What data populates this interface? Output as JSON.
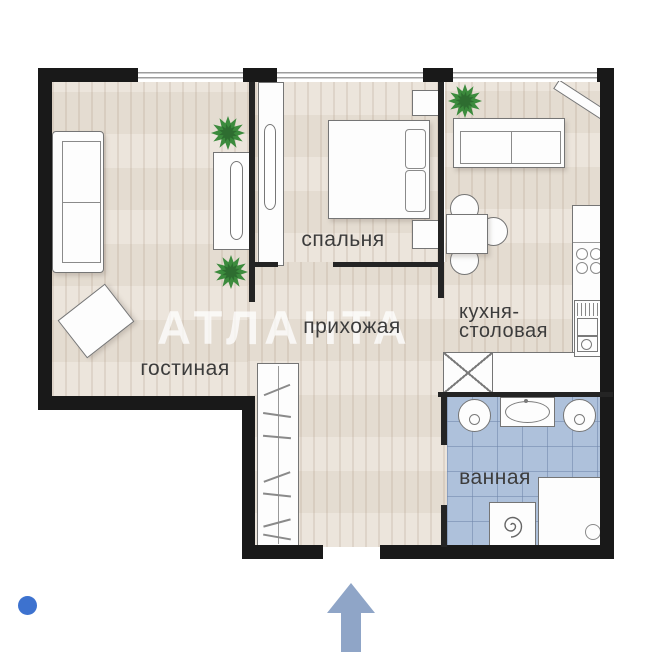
{
  "floorplan": {
    "watermark": "АТЛАНТА",
    "rooms": {
      "living": {
        "label": "гостиная"
      },
      "bedroom": {
        "label": "спальня"
      },
      "hallway": {
        "label": "прихожая"
      },
      "kitchen": {
        "line1": "кухня-",
        "line2": "столовая"
      },
      "bathroom": {
        "label": "ванная"
      }
    },
    "icons": {
      "entrance_arrow": "arrow-up",
      "carousel_dot": "dot",
      "plants": "starburst-plant"
    },
    "colors": {
      "wall": "#191919",
      "floor_wood": "#e9e1d6",
      "floor_tile": "#aec1db",
      "watermark": "rgba(255,255,255,0.75)",
      "entrance_arrow": "#8fa5c7",
      "carousel_dot": "#3d72cf",
      "plant_green": "#3c8b3d",
      "label_text": "#3c3c3c"
    }
  }
}
